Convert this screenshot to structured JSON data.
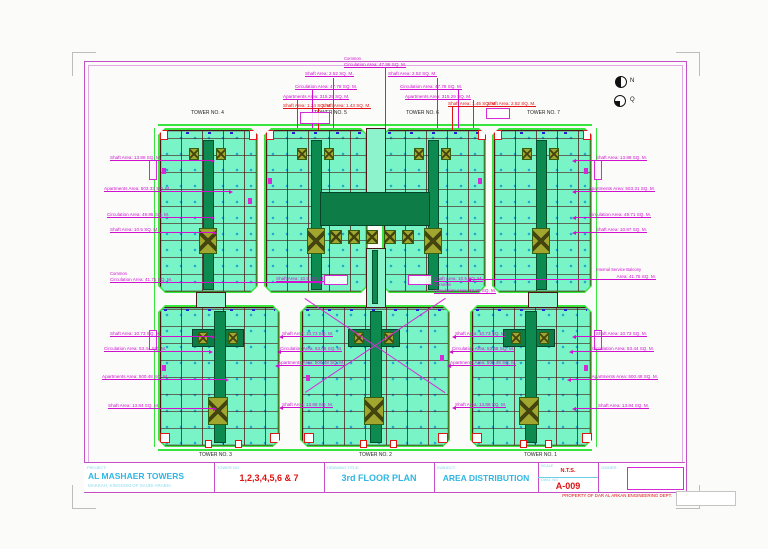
{
  "sheet": {
    "footer_note": "PROPERTY OF DAR AL ARKAN ENGINEERING DEPT.",
    "compass": {
      "north": "N",
      "qibla": "Q"
    }
  },
  "title_block": {
    "project_label": "PROJECT:",
    "project_name": "AL MASHAER TOWERS",
    "project_location": "MAKKAH, KINGDOM OF SAUDI ARABIA",
    "tower_no_label": "TOWER NO",
    "tower_no_value": "1,2,3,4,5,6 & 7",
    "drawing_title_label": "DRAWING TITLE:",
    "drawing_title_value": "3rd FLOOR PLAN",
    "subject_label": "SUBJECT:",
    "subject_value": "AREA DISTRIBUTION",
    "scale_label": "SCALE",
    "scale_value": "N.T.S.",
    "dwg_no_label": "DWG. NO",
    "dwg_no_value": "A-009",
    "owner_label": "OWNER:"
  },
  "towers": {
    "top": [
      "TOWER NO. 4",
      "TOWER NO. 5",
      "TOWER NO. 6",
      "TOWER NO. 7"
    ],
    "bottom": [
      "TOWER NO. 3",
      "TOWER NO. 2",
      "TOWER NO. 1"
    ]
  },
  "annotations": {
    "left": [
      "Shaft Area: 13.88 SQ. M.",
      "Apartments Area: 503.33 SQ. M.",
      "Circulation Area: 49.85 SQ. M.",
      "Shaft Area: 10.5 SQ. M.",
      "Common",
      "Circulation Area: 41.75 SQ. M.",
      "Shaft Area: 10.73 SQ. M.",
      "Circulation Area: 53.44 SQ. M.",
      "Apartments Area: 500.48 SQ. M.",
      "Shaft Area: 13.84 SQ. M."
    ],
    "right": [
      "Shaft Area: 13.88 SQ. M.",
      "Apartments Area: 503.31 SQ. M.",
      "Circulation Area: 49.71 SQ. M.",
      "Shaft Area: 10.87 SQ. M.",
      "Internal Service Balcony",
      "Area: 41.75 SQ. M.",
      "Shaft Area: 10.73 SQ. M.",
      "Circulation Area: 53.44 SQ. M.",
      "Apartments Area: 500.48 SQ. M.",
      "Shaft Area: 13.84 SQ. M."
    ],
    "top": [
      "Common",
      "Circulation Area: 47.86 SQ. M.",
      "Shaft Area: 2.52 SQ. M.",
      "Shaft Area: 2.52 SQ. M.",
      "Circulation Area: 47.78 SQ. M.",
      "Circulation Area: 47.78 SQ. M.",
      "Apartments Area: 315.29 SQ. M.",
      "Apartments Area: 315.29 SQ. M.",
      "Shaft Area: 1.24 SQ. M.",
      "Shaft Area: 1.43 SQ. M.",
      "Shaft Area: 1.45 SQ. M.",
      "Shaft Area: 2.52 SQ. M."
    ],
    "center": [
      "Shaft Area: 10.5 SQ. M.",
      "Shaft Area: 10.5 SQ. M.",
      "Common",
      "Circulation Area: 33.99 SQ. M.",
      "Shaft Area: 10.73 SQ. M.",
      "Circulation Area: 53.68 SQ. M.",
      "Apartments Area: 500.48 SQ. M.",
      "Shaft Area: 13.88 SQ. M.",
      "Shaft Area: 10.73 SQ. M.",
      "Circulation Area: 53.68 SQ. M.",
      "Apartments Area: 500.48 SQ. M.",
      "Shaft Area: 13.88 SQ. M."
    ]
  }
}
